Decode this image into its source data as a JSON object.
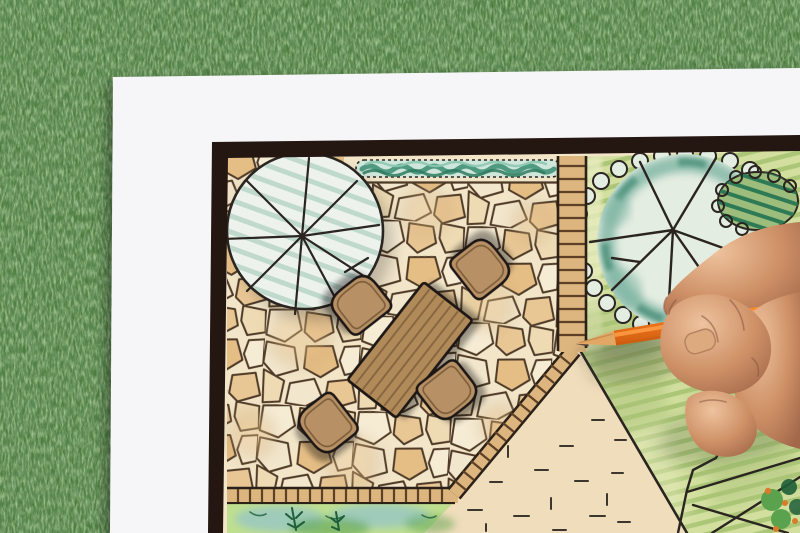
{
  "scene": {
    "description": "Overhead photograph of a hand drawing a backyard garden landscape plan with an orange colored pencil on a white sheet lying on green grass",
    "objects": [
      "grass-lawn-background",
      "white-paper-sheet",
      "plan-border-frame",
      "flagstone-patio",
      "shade-tree-symbol",
      "hedge-row",
      "garden-table",
      "garden-chairs",
      "brick-path",
      "brick-edging",
      "lawn-area",
      "canopy-tree-symbol",
      "hatched-shrub",
      "gravel-area",
      "groundcover-bed",
      "pond-outline",
      "plant-cluster",
      "orange-pencil",
      "drawing-hand"
    ]
  },
  "palette": {
    "grass_base": "#4a7a3c",
    "grass_dark": "#24491e",
    "grass_light": "#78ab58",
    "grass_speck": "#d1ddc6",
    "paper": "#f6f6f8",
    "frame": "#241611",
    "plan_bg": "#f2e5c8",
    "plan_line": "#2b2521",
    "stone_line": "#4e3a27",
    "stone_cream": "#f6ecd4",
    "stone_warm": "#eedbb4",
    "stone_tan": "#e9c795",
    "stone_pale": "#f2e6cc",
    "stone_gold": "#e5be85",
    "hedge_base": "#cfe6da",
    "hedge_dark": "#2f7a60",
    "hedge_mid": "#4f9a80",
    "hedge_light": "#8cc8b2",
    "tree1_fill": "#edf2ec",
    "tree1_stripe": "#b7d5c8",
    "path_fill": "#ddb57e",
    "path_rung": "#5d4026",
    "path_edge": "#2c2118",
    "lawn_base": "#d2df9e",
    "lawn_stripe": "#92b55e",
    "lawn_shade": "#a9c278",
    "lawn_light": "#e9ecc0",
    "tree2_fill": "#e4ede2",
    "tree2_teal": "#7db4a2",
    "tree2_teal_dark": "#4b8f7a",
    "bush_fill": "#9dbd7c",
    "bush_hatch": "#2d7a55",
    "table_wood": "#b18a5a",
    "table_stripe": "#876640",
    "outline_dark": "#1f1812",
    "chair_wood": "#b79165",
    "chair_edge": "#7c5c39",
    "sand_fill": "#f0ddbb",
    "sand_dash": "#3c362e",
    "bed_wash": "#9fcbba",
    "bed_green": "#5aa24e",
    "bed_dark": "#1e5e38",
    "bed_light": "#bfdf8f",
    "pencil_orange": "#f37a1c",
    "pencil_orange_light": "#ff9e45",
    "pencil_orange_dark": "#cf5d10",
    "pencil_wood": "#e2a765",
    "pencil_tip": "#463c33",
    "skin_base": "#cf9268",
    "skin_light": "#eec39e",
    "skin_shadow": "#9c6247",
    "skin_crease": "#8a5640"
  }
}
